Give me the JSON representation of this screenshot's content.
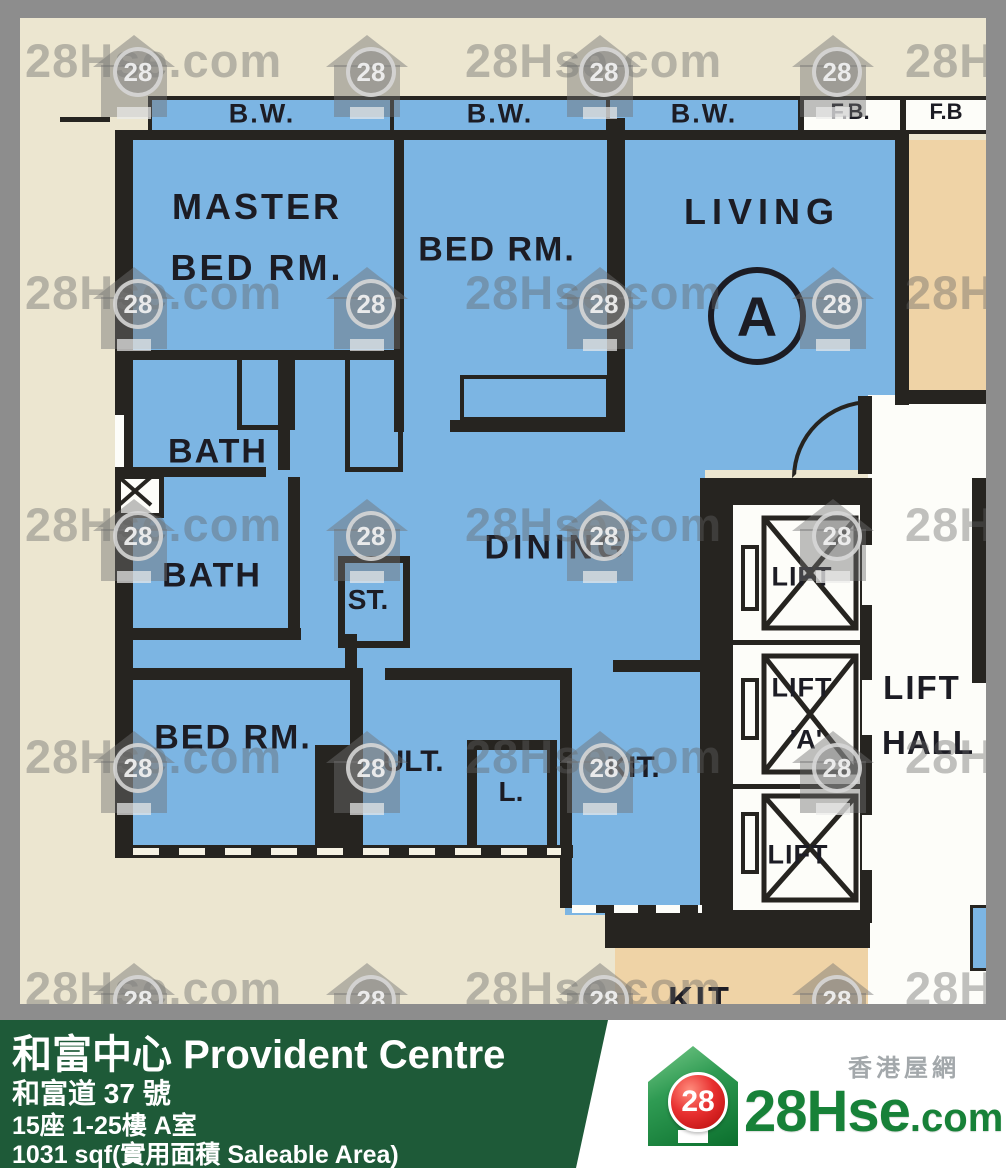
{
  "watermark": {
    "text": "28Hse.com",
    "badge": "28"
  },
  "plan": {
    "bw_labels": [
      "B.W.",
      "B.W.",
      "B.W."
    ],
    "fb_labels": [
      "F.B.",
      "F.B"
    ],
    "unit_marker": "A",
    "rooms": {
      "master_bedroom_line1": "MASTER",
      "master_bedroom_line2": "BED RM.",
      "bedroom_top": "BED RM.",
      "living": "LIVING",
      "bath_upper": "BATH",
      "bath_lower": "BATH",
      "store": "ST.",
      "dining": "DINING",
      "bedroom_lower": "BED RM.",
      "utility": "ULT.",
      "lavatory": "L.",
      "kitchen": "KIT.",
      "neighbor_kitchen": "KIT"
    },
    "lifts": {
      "top": "LIFT",
      "middle": "LIFT",
      "middle_letter": "'A'",
      "bottom": "LIFT",
      "hall_line1": "LIFT",
      "hall_line2": "HALL"
    }
  },
  "footer": {
    "building_name": "和富中心 Provident Centre",
    "address": "和富道 37 號",
    "block_floor_unit": "15座 1-25樓 A室",
    "area": "1031 sqf(實用面積 Saleable Area)",
    "brand": {
      "site_cn": "香港屋網",
      "logo_main": "28Hse",
      "logo_suffix": ".com",
      "badge": "28"
    }
  },
  "colors": {
    "plan_blue": "#7cb5e3",
    "neighbor_tan": "#efd3a6",
    "background_cream": "#ece6d0",
    "frame_gray": "#8d8d8d",
    "wall_dark": "#262420",
    "footer_green": "#1e5a38",
    "brand_green": "#178138",
    "badge_red": "#d91515"
  }
}
